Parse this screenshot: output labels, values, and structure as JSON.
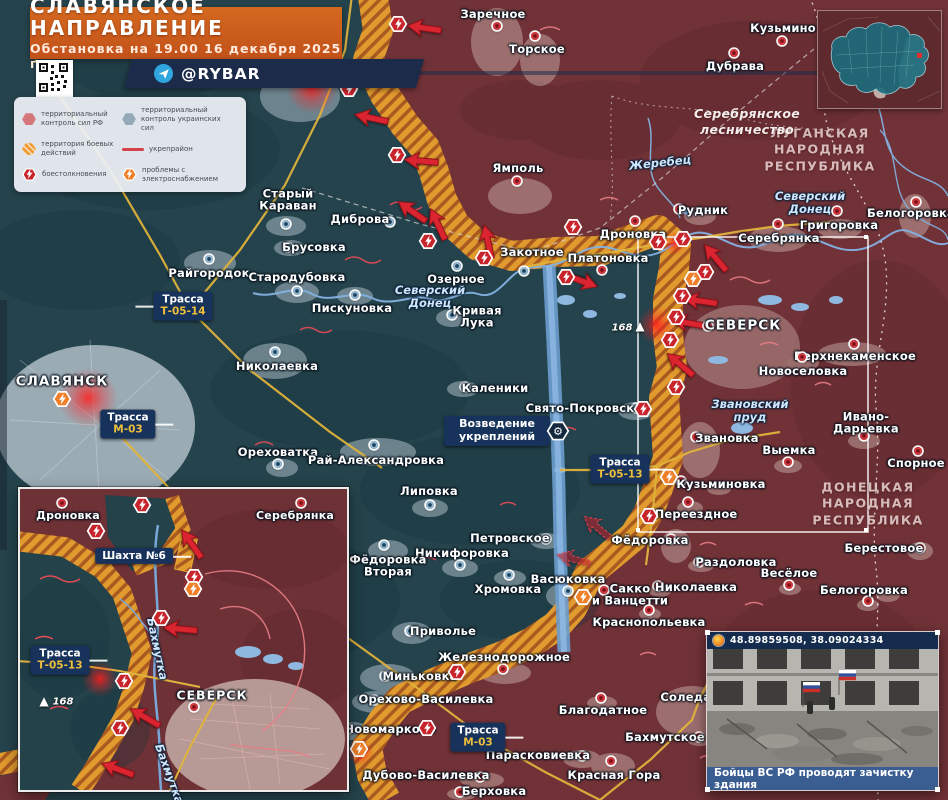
{
  "header": {
    "title": "СЛАВЯНСКОЕ НАПРАВЛЕНИЕ",
    "subtitle": "Обстановка на 19.00 16 декабря 2025 г.",
    "channel": "@RYBAR"
  },
  "legend": {
    "items": [
      {
        "label": "территориальный контроль сил РФ"
      },
      {
        "label": "территориальный контроль украинских сил"
      },
      {
        "label": "территория боевых действий"
      },
      {
        "label": "укрепрайон"
      },
      {
        "label": "боестолкновения"
      },
      {
        "label": "проблемы с электроснабжением"
      }
    ]
  },
  "colors": {
    "rf_zone": "#703237",
    "ua_zone": "#25434c",
    "combat_hatch": "#e09a2e",
    "accent_orange": "#d4691f",
    "badge_navy": "#17335c"
  },
  "map": {
    "regions": [
      {
        "text": "ЛУГАНСКАЯ\nНАРОДНАЯ\nРЕСПУБЛИКА",
        "x": 820,
        "y": 150
      },
      {
        "text": "ДОНЕЦКАЯ\nНАРОДНАЯ\nРЕСПУБЛИКА",
        "x": 868,
        "y": 504
      },
      {
        "text": "Серебрянское\nлесничество",
        "x": 747,
        "y": 122,
        "f": true
      }
    ],
    "rivers": [
      {
        "text": "Северский\nДонец",
        "x": 430,
        "y": 297
      },
      {
        "text": "Северский\nДонец",
        "x": 810,
        "y": 203
      },
      {
        "text": "Жеребец",
        "x": 660,
        "y": 163,
        "rot": -6
      },
      {
        "text": "Звановский\nпруд",
        "x": 750,
        "y": 411
      }
    ],
    "roads": [
      {
        "l1": "Трасса",
        "l2": "Т-05-14",
        "x": 183,
        "y": 306,
        "tail": "l"
      },
      {
        "l1": "Трасса",
        "l2": "М-03",
        "x": 128,
        "y": 424,
        "tail": "r"
      },
      {
        "l1": "Трасса",
        "l2": "Т-05-13",
        "x": 620,
        "y": 469,
        "tail": "r"
      },
      {
        "l1": "Трасса",
        "l2": "М-03",
        "x": 478,
        "y": 737,
        "tail": "r"
      }
    ],
    "fort": {
      "text": "Возведение\nукреплений",
      "x": 497,
      "y": 431,
      "gx": 558,
      "gy": 431
    },
    "elevation": {
      "text": "168",
      "x": 622,
      "y": 328,
      "tx": 640,
      "ty": 326
    },
    "cities": [
      {
        "n": "Лиман",
        "d": "ua",
        "x": 310,
        "y": 81,
        "lx": 346,
        "ly": 81,
        "big": true
      },
      {
        "n": "Заречное",
        "d": "ru",
        "x": 497,
        "y": 26,
        "lx": 493,
        "ly": 14
      },
      {
        "n": "Торское",
        "d": "ru",
        "x": 535,
        "y": 36,
        "lx": 537,
        "ly": 49
      },
      {
        "n": "Ямполь",
        "d": "ru",
        "x": 517,
        "y": 181,
        "lx": 518,
        "ly": 168
      },
      {
        "n": "Кузьмино",
        "d": "ru",
        "x": 782,
        "y": 41,
        "lx": 783,
        "ly": 28
      },
      {
        "n": "Дубрава",
        "d": "ru",
        "x": 734,
        "y": 53,
        "lx": 735,
        "ly": 66
      },
      {
        "n": "Старый\nКараван",
        "d": "ua",
        "x": 286,
        "y": 224,
        "lx": 288,
        "ly": 200
      },
      {
        "n": "Брусовка",
        "d": "ua",
        "x": 288,
        "y": 247,
        "lx": 314,
        "ly": 247
      },
      {
        "n": "Райгородок",
        "d": "ua",
        "x": 209,
        "y": 259,
        "lx": 209,
        "ly": 273
      },
      {
        "n": "Стародубовка",
        "d": "ua",
        "x": 297,
        "y": 291,
        "lx": 297,
        "ly": 277
      },
      {
        "n": "Диброва",
        "d": "ua",
        "x": 390,
        "y": 222,
        "lx": 360,
        "ly": 219
      },
      {
        "n": "Озерное",
        "d": "ua",
        "x": 457,
        "y": 266,
        "lx": 456,
        "ly": 279
      },
      {
        "n": "Закотное",
        "d": "ua",
        "x": 524,
        "y": 271,
        "lx": 532,
        "ly": 252
      },
      {
        "n": "Платоновка",
        "d": "ru",
        "x": 602,
        "y": 270,
        "lx": 608,
        "ly": 258
      },
      {
        "n": "Пискуновка",
        "d": "ua",
        "x": 355,
        "y": 295,
        "lx": 352,
        "ly": 308
      },
      {
        "n": "Кривая\nЛука",
        "d": "ua",
        "x": 452,
        "y": 315,
        "lx": 477,
        "ly": 317
      },
      {
        "n": "Николаевка",
        "d": "ua",
        "x": 275,
        "y": 352,
        "lx": 277,
        "ly": 366
      },
      {
        "n": "Каленики",
        "d": "ua",
        "x": 465,
        "y": 387,
        "lx": 495,
        "ly": 388
      },
      {
        "n": "Свято-Покровское",
        "d": "ua",
        "x": 636,
        "y": 408,
        "lx": 588,
        "ly": 408
      },
      {
        "n": "СЛАВЯНСК",
        "d": "no",
        "x": 62,
        "y": 398,
        "lx": 62,
        "ly": 382,
        "big": true
      },
      {
        "n": "Ореховатка",
        "d": "ua",
        "x": 278,
        "y": 464,
        "lx": 278,
        "ly": 452
      },
      {
        "n": "Рай-Александровка",
        "d": "ua",
        "x": 374,
        "y": 445,
        "lx": 376,
        "ly": 460
      },
      {
        "n": "Липовка",
        "d": "ua",
        "x": 430,
        "y": 505,
        "lx": 429,
        "ly": 491
      },
      {
        "n": "Петровское",
        "d": "ua",
        "x": 546,
        "y": 539,
        "lx": 510,
        "ly": 538
      },
      {
        "n": "Никифоровка",
        "d": "ua",
        "x": 460,
        "y": 565,
        "lx": 462,
        "ly": 553
      },
      {
        "n": "Фёдоровка\nВторая",
        "d": "ua",
        "x": 384,
        "y": 545,
        "lx": 388,
        "ly": 566
      },
      {
        "n": "Хромовка",
        "d": "ua",
        "x": 509,
        "y": 575,
        "lx": 508,
        "ly": 589
      },
      {
        "n": "Васюковка",
        "d": "ua",
        "x": 568,
        "y": 591,
        "lx": 568,
        "ly": 579
      },
      {
        "n": "Приволье",
        "d": "ua",
        "x": 410,
        "y": 631,
        "lx": 443,
        "ly": 631
      },
      {
        "n": "Миньковка",
        "d": "ua",
        "x": 385,
        "y": 676,
        "lx": 420,
        "ly": 676
      },
      {
        "n": "Орехово-Василевка",
        "d": "ua",
        "x": 374,
        "y": 700,
        "lx": 426,
        "ly": 699
      },
      {
        "n": "Новомарково",
        "d": "ua",
        "x": 348,
        "y": 729,
        "lx": 390,
        "ly": 729
      },
      {
        "n": "Рудник",
        "d": "ru",
        "x": 679,
        "y": 209,
        "lx": 703,
        "ly": 210
      },
      {
        "n": "Дроновка",
        "d": "ru",
        "x": 635,
        "y": 221,
        "lx": 633,
        "ly": 234
      },
      {
        "n": "Серебрянка",
        "d": "ru",
        "x": 778,
        "y": 224,
        "lx": 779,
        "ly": 238
      },
      {
        "n": "Григоровка",
        "d": "ru",
        "x": 837,
        "y": 211,
        "lx": 839,
        "ly": 225
      },
      {
        "n": "Белогоровка",
        "d": "ru",
        "x": 916,
        "y": 202,
        "lx": 911,
        "ly": 213
      },
      {
        "n": "СЕВЕРСК",
        "d": "ru",
        "x": 708,
        "y": 326,
        "lx": 743,
        "ly": 326,
        "big": true
      },
      {
        "n": "Верхнекаменское",
        "d": "ru",
        "x": 854,
        "y": 344,
        "lx": 855,
        "ly": 356
      },
      {
        "n": "Новоселовка",
        "d": "ru",
        "x": 802,
        "y": 357,
        "lx": 803,
        "ly": 371
      },
      {
        "n": "Звановка",
        "d": "ru",
        "x": 696,
        "y": 437,
        "lx": 727,
        "ly": 438
      },
      {
        "n": "Выемка",
        "d": "ru",
        "x": 788,
        "y": 462,
        "lx": 789,
        "ly": 450
      },
      {
        "n": "Ивано-Дарьевка",
        "d": "ru",
        "x": 864,
        "y": 436,
        "lx": 866,
        "ly": 423
      },
      {
        "n": "Спорное",
        "d": "ru",
        "x": 918,
        "y": 451,
        "lx": 916,
        "ly": 463
      },
      {
        "n": "Кузьминовка",
        "d": "ru",
        "x": 681,
        "y": 481,
        "lx": 721,
        "ly": 484
      },
      {
        "n": "Переездное",
        "d": "ru",
        "x": 688,
        "y": 502,
        "lx": 696,
        "ly": 514
      },
      {
        "n": "Фёдоровка",
        "d": "ru",
        "x": 671,
        "y": 539,
        "lx": 650,
        "ly": 540
      },
      {
        "n": "Раздоловка",
        "d": "ru",
        "x": 699,
        "y": 562,
        "lx": 736,
        "ly": 562
      },
      {
        "n": "Николаевка",
        "d": "ru",
        "x": 658,
        "y": 586,
        "lx": 696,
        "ly": 587
      },
      {
        "n": "Сакко\nи Ванцетти",
        "d": "ru",
        "x": 604,
        "y": 590,
        "lx": 630,
        "ly": 595
      },
      {
        "n": "Краснопольевка",
        "d": "ru",
        "x": 649,
        "y": 610,
        "lx": 649,
        "ly": 622
      },
      {
        "n": "Весёлое",
        "d": "ru",
        "x": 789,
        "y": 585,
        "lx": 789,
        "ly": 573
      },
      {
        "n": "Берестовое",
        "d": "ru",
        "x": 920,
        "y": 548,
        "lx": 884,
        "ly": 548
      },
      {
        "n": "Белогоровка",
        "d": "ru",
        "x": 868,
        "y": 601,
        "lx": 864,
        "ly": 590
      },
      {
        "n": "Железнодорожное",
        "d": "ru",
        "x": 503,
        "y": 669,
        "lx": 504,
        "ly": 657
      },
      {
        "n": "Благодатное",
        "d": "ru",
        "x": 601,
        "y": 698,
        "lx": 603,
        "ly": 710
      },
      {
        "n": "Соледар",
        "d": "no",
        "x": 660,
        "y": 697,
        "lx": 690,
        "ly": 697
      },
      {
        "n": "Бахмутское",
        "d": "ru",
        "x": 699,
        "y": 737,
        "lx": 665,
        "ly": 737
      },
      {
        "n": "Парасковиевка",
        "d": "ru",
        "x": 582,
        "y": 756,
        "lx": 538,
        "ly": 755
      },
      {
        "n": "Красная Гора",
        "d": "ru",
        "x": 611,
        "y": 761,
        "lx": 614,
        "ly": 775
      },
      {
        "n": "Дубово-Василевка",
        "d": "ru",
        "x": 480,
        "y": 777,
        "lx": 426,
        "ly": 775
      },
      {
        "n": "Берховка",
        "d": "ru",
        "x": 460,
        "y": 792,
        "lx": 494,
        "ly": 791
      }
    ],
    "clashes": [
      {
        "x": 398,
        "y": 24
      },
      {
        "x": 349,
        "y": 89
      },
      {
        "x": 397,
        "y": 155
      },
      {
        "x": 428,
        "y": 241
      },
      {
        "x": 484,
        "y": 258
      },
      {
        "x": 573,
        "y": 227
      },
      {
        "x": 658,
        "y": 242
      },
      {
        "x": 683,
        "y": 239
      },
      {
        "x": 566,
        "y": 277
      },
      {
        "x": 705,
        "y": 272
      },
      {
        "x": 682,
        "y": 296
      },
      {
        "x": 676,
        "y": 317
      },
      {
        "x": 670,
        "y": 340
      },
      {
        "x": 676,
        "y": 387
      },
      {
        "x": 643,
        "y": 409
      },
      {
        "x": 649,
        "y": 516
      },
      {
        "x": 457,
        "y": 672
      },
      {
        "x": 427,
        "y": 728
      }
    ],
    "power": [
      {
        "x": 62,
        "y": 399
      },
      {
        "x": 693,
        "y": 279
      },
      {
        "x": 669,
        "y": 477
      },
      {
        "x": 583,
        "y": 597
      },
      {
        "x": 359,
        "y": 749
      }
    ],
    "arrows": [
      {
        "x": 424,
        "y": 28,
        "r": 8
      },
      {
        "x": 371,
        "y": 118,
        "r": 12
      },
      {
        "x": 421,
        "y": 161,
        "r": 5
      },
      {
        "x": 411,
        "y": 211,
        "r": 35
      },
      {
        "x": 436,
        "y": 223,
        "r": 65
      },
      {
        "x": 486,
        "y": 240,
        "r": 78
      },
      {
        "x": 582,
        "y": 277,
        "r": 200
      },
      {
        "x": 714,
        "y": 257,
        "r": 50
      },
      {
        "x": 700,
        "y": 301,
        "r": 8
      },
      {
        "x": 688,
        "y": 323,
        "r": 10
      },
      {
        "x": 679,
        "y": 364,
        "r": 40
      },
      {
        "x": 596,
        "y": 527,
        "r": 40,
        "d": true
      },
      {
        "x": 573,
        "y": 559,
        "r": 15,
        "d": true
      }
    ]
  },
  "inset_map": {
    "cities": [
      {
        "n": "Дроновка",
        "d": "ru",
        "x": 42,
        "y": 14,
        "lx": 48,
        "ly": 27
      },
      {
        "n": "Серебрянка",
        "d": "ru",
        "x": 281,
        "y": 14,
        "lx": 275,
        "ly": 27
      },
      {
        "n": "СЕВЕРСК",
        "d": "ru",
        "x": 174,
        "y": 218,
        "lx": 192,
        "ly": 206,
        "big": true
      }
    ],
    "roads": [
      {
        "l1": "Шахта №6",
        "x": 114,
        "y": 67,
        "tail": "r"
      },
      {
        "l1": "Трасса",
        "l2": "Т-05-13",
        "x": 40,
        "y": 171,
        "tail": "r"
      }
    ],
    "rivers": [
      {
        "text": "Бахмутка",
        "x": 137,
        "y": 160,
        "rot": 78
      },
      {
        "text": "Бахмутка",
        "x": 149,
        "y": 285,
        "rot": 70
      }
    ],
    "elevation": {
      "text": "168",
      "x": 43,
      "y": 213,
      "tx": 24,
      "ty": 212
    },
    "clashes": [
      {
        "x": 76,
        "y": 42
      },
      {
        "x": 122,
        "y": 16
      },
      {
        "x": 174,
        "y": 88
      },
      {
        "x": 141,
        "y": 129
      },
      {
        "x": 104,
        "y": 192
      },
      {
        "x": 100,
        "y": 239
      }
    ],
    "power": [
      {
        "x": 173,
        "y": 100
      }
    ],
    "arrows": [
      {
        "x": 170,
        "y": 54,
        "r": 55
      },
      {
        "x": 160,
        "y": 140,
        "r": 5
      },
      {
        "x": 124,
        "y": 228,
        "r": 30
      },
      {
        "x": 97,
        "y": 280,
        "r": 20
      }
    ]
  },
  "photo": {
    "coordinates": "48.89859508, 38.09024334",
    "caption": "Бойцы ВС РФ проводят зачистку здания"
  }
}
